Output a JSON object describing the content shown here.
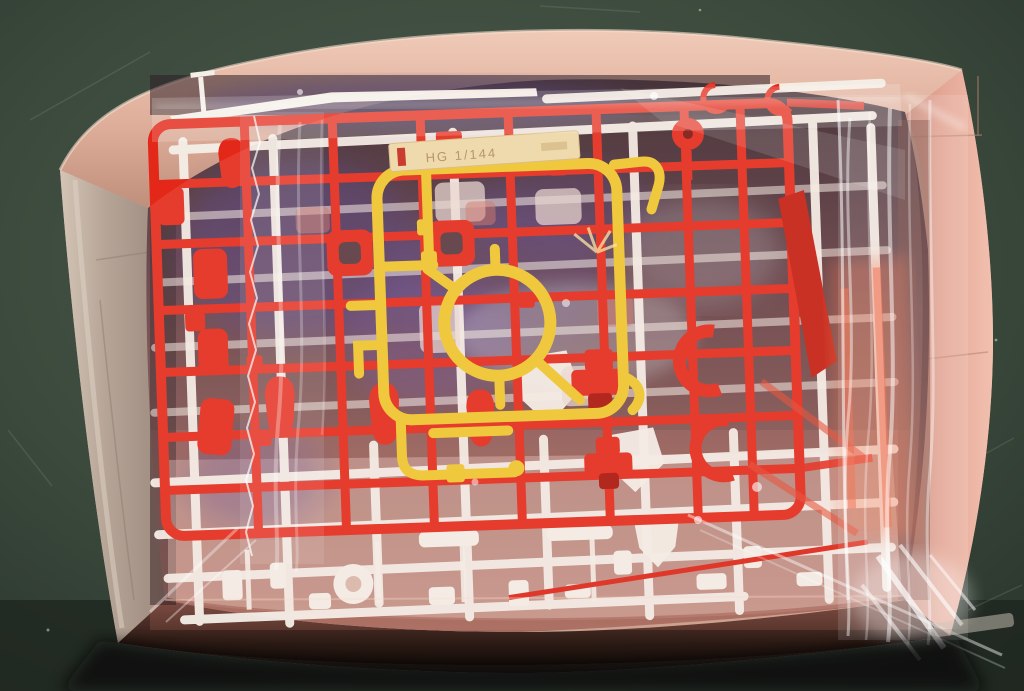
{
  "meta": {
    "alt": "Open model kit cardboard box seen from above on a dark green mat; inside a clear plastic bag are plastic part runners: a large red sprue over a white sprue, with a small yellow sprue with a ring on top"
  },
  "label_tag": {
    "text": "HG 1/144"
  },
  "colors": {
    "mat_green": "#4c5a4c",
    "mat_green_dark": "#2b362c",
    "box_rim": "#e5bba8",
    "box_rim_shadow": "#c08f7c",
    "left_wall": "#b5a496",
    "right_wall": "#e9b1a1",
    "interior_dark": "#553740",
    "front_shadow": "#130d0a",
    "sprue_red": "#e32819",
    "sprue_red_dark": "#a81208",
    "sprue_red_deep": "#c21d0f",
    "sprue_white": "#f4efe8",
    "sprue_yellow": "#efc72b",
    "label_bg": "#eedcab",
    "label_text_color": "#a07a50",
    "reflection_blue": "#5448ac",
    "reflection_silver": "#ccd1db",
    "orange_through_bag": "#f06a3e",
    "bag_white": "#ffffff"
  }
}
